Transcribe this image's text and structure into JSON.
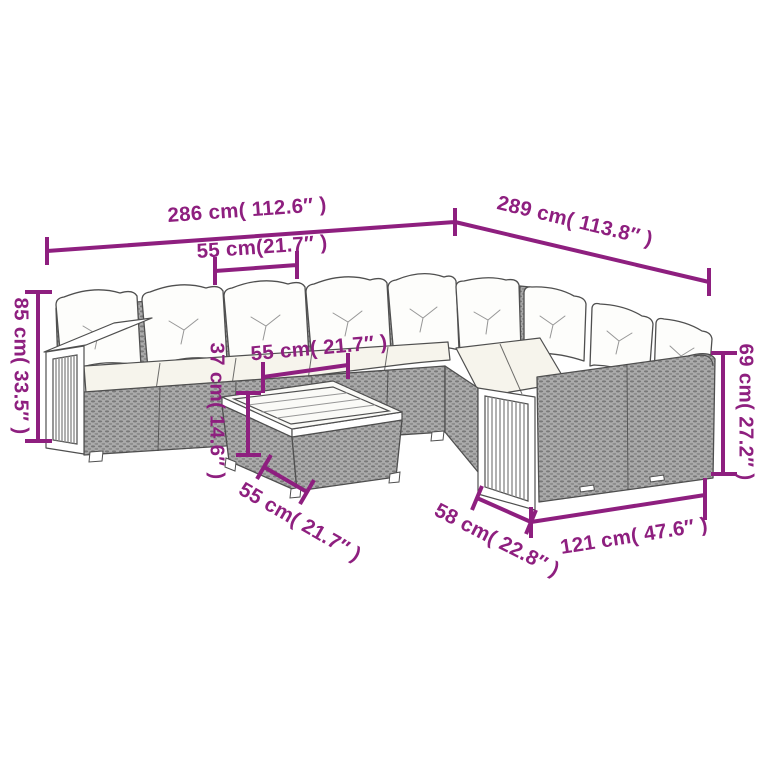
{
  "diagram": {
    "type": "product-dimension-diagram",
    "subject": "Rattan garden corner sofa set with white cushions, wooden slat armrests and coffee table (isometric line drawing)",
    "colors": {
      "accent": "#8e1f7f",
      "line_art": "#4f4f4f",
      "background": "#ffffff",
      "rattan_fill": "#aaaaaa"
    },
    "dimensions": {
      "overall_width_left": {
        "label": "286 cm( 112.6″ )",
        "cm": 286,
        "inches": 112.6
      },
      "overall_width_right": {
        "label": "289 cm( 113.8″ )",
        "cm": 289,
        "inches": 113.8
      },
      "seat_module_width": {
        "label": "55 cm(21.7″ )",
        "cm": 55,
        "inches": 21.7
      },
      "backrest_height": {
        "label": "85 cm( 33.5″ )",
        "cm": 85,
        "inches": 33.5
      },
      "table_width": {
        "label": "55 cm( 21.7″ )",
        "cm": 55,
        "inches": 21.7
      },
      "table_height": {
        "label": "37 cm( 14.6″ )",
        "cm": 37,
        "inches": 14.6
      },
      "table_depth": {
        "label": "55 cm( 21.7″ )",
        "cm": 55,
        "inches": 21.7
      },
      "seat_depth_right": {
        "label": "58 cm( 22.8″ )",
        "cm": 58,
        "inches": 22.8
      },
      "right_section_width": {
        "label": "121 cm( 47.6″ )",
        "cm": 121,
        "inches": 47.6
      },
      "arm_height_right": {
        "label": "69 cm( 27.2″ )",
        "cm": 69,
        "inches": 27.2
      }
    }
  }
}
